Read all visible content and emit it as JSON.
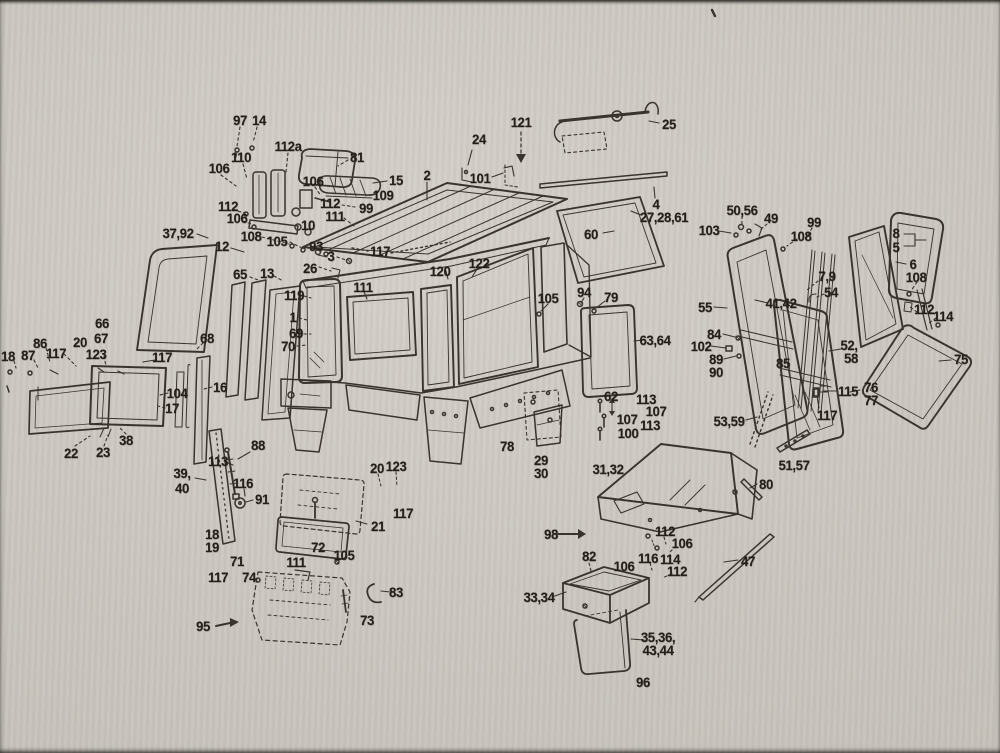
{
  "document": {
    "type": "scanned exploded-parts diagram",
    "subject": "tractor cab assembly parts figure with numbered callouts"
  },
  "colors": {
    "paper": "#cac6bf",
    "ink": "#2e2922"
  },
  "labels": [
    {
      "t": "97",
      "x": 240,
      "y": 120
    },
    {
      "t": "14",
      "x": 259,
      "y": 120
    },
    {
      "t": "112a",
      "x": 288,
      "y": 146
    },
    {
      "t": "110",
      "x": 241,
      "y": 157
    },
    {
      "t": "106",
      "x": 219,
      "y": 168
    },
    {
      "t": "81",
      "x": 357,
      "y": 157
    },
    {
      "t": "106",
      "x": 313,
      "y": 181
    },
    {
      "t": "15",
      "x": 396,
      "y": 180
    },
    {
      "t": "109",
      "x": 383,
      "y": 195
    },
    {
      "t": "112",
      "x": 330,
      "y": 203
    },
    {
      "t": "99",
      "x": 366,
      "y": 208
    },
    {
      "t": "111",
      "x": 335,
      "y": 216
    },
    {
      "t": "112",
      "x": 228,
      "y": 206
    },
    {
      "t": "106",
      "x": 237,
      "y": 218
    },
    {
      "t": "10",
      "x": 308,
      "y": 225
    },
    {
      "t": "108",
      "x": 251,
      "y": 236
    },
    {
      "t": "105",
      "x": 277,
      "y": 241
    },
    {
      "t": "12",
      "x": 222,
      "y": 246
    },
    {
      "t": "37,92",
      "x": 178,
      "y": 233
    },
    {
      "t": "93",
      "x": 316,
      "y": 246
    },
    {
      "t": "3",
      "x": 331,
      "y": 256
    },
    {
      "t": "26",
      "x": 310,
      "y": 268
    },
    {
      "t": "117",
      "x": 380,
      "y": 251
    },
    {
      "t": "65",
      "x": 240,
      "y": 274
    },
    {
      "t": "13",
      "x": 267,
      "y": 273
    },
    {
      "t": "119",
      "x": 294,
      "y": 295
    },
    {
      "t": "1",
      "x": 293,
      "y": 317
    },
    {
      "t": "69",
      "x": 296,
      "y": 333
    },
    {
      "t": "70",
      "x": 288,
      "y": 346
    },
    {
      "t": "66",
      "x": 102,
      "y": 323
    },
    {
      "t": "67",
      "x": 101,
      "y": 338
    },
    {
      "t": "20",
      "x": 80,
      "y": 342
    },
    {
      "t": "86",
      "x": 40,
      "y": 343
    },
    {
      "t": "18",
      "x": 8,
      "y": 356
    },
    {
      "t": "87",
      "x": 28,
      "y": 355
    },
    {
      "t": "117",
      "x": 56,
      "y": 353
    },
    {
      "t": "123",
      "x": 96,
      "y": 354
    },
    {
      "t": "117",
      "x": 162,
      "y": 357
    },
    {
      "t": "68",
      "x": 207,
      "y": 338
    },
    {
      "t": "104",
      "x": 177,
      "y": 393
    },
    {
      "t": "17",
      "x": 172,
      "y": 408
    },
    {
      "t": "16",
      "x": 220,
      "y": 387
    },
    {
      "t": "38",
      "x": 126,
      "y": 440
    },
    {
      "t": "22",
      "x": 71,
      "y": 453
    },
    {
      "t": "23",
      "x": 103,
      "y": 452
    },
    {
      "t": "121",
      "x": 521,
      "y": 122
    },
    {
      "t": "24",
      "x": 479,
      "y": 139
    },
    {
      "t": "101",
      "x": 480,
      "y": 178
    },
    {
      "t": "25",
      "x": 669,
      "y": 124
    },
    {
      "t": "2",
      "x": 427,
      "y": 175
    },
    {
      "t": "4",
      "x": 656,
      "y": 204
    },
    {
      "t": "27,28,61",
      "x": 664,
      "y": 217
    },
    {
      "t": "60",
      "x": 591,
      "y": 234
    },
    {
      "t": "120",
      "x": 440,
      "y": 271
    },
    {
      "t": "122",
      "x": 479,
      "y": 263
    },
    {
      "t": "111",
      "x": 363,
      "y": 287
    },
    {
      "t": "105",
      "x": 548,
      "y": 298
    },
    {
      "t": "94",
      "x": 584,
      "y": 292
    },
    {
      "t": "79",
      "x": 611,
      "y": 297
    },
    {
      "t": "63,64",
      "x": 655,
      "y": 340
    },
    {
      "t": "50,56",
      "x": 742,
      "y": 210
    },
    {
      "t": "49",
      "x": 771,
      "y": 218
    },
    {
      "t": "99",
      "x": 814,
      "y": 222
    },
    {
      "t": "103",
      "x": 709,
      "y": 230
    },
    {
      "t": "108",
      "x": 801,
      "y": 236
    },
    {
      "t": "7,9",
      "x": 827,
      "y": 276
    },
    {
      "t": "54",
      "x": 831,
      "y": 292
    },
    {
      "t": "8",
      "x": 896,
      "y": 233
    },
    {
      "t": "5",
      "x": 896,
      "y": 247
    },
    {
      "t": "6",
      "x": 913,
      "y": 264
    },
    {
      "t": "108",
      "x": 916,
      "y": 277
    },
    {
      "t": "112",
      "x": 924,
      "y": 309
    },
    {
      "t": "114",
      "x": 943,
      "y": 316
    },
    {
      "t": "55",
      "x": 705,
      "y": 307
    },
    {
      "t": "41,42",
      "x": 781,
      "y": 303
    },
    {
      "t": "84",
      "x": 714,
      "y": 334
    },
    {
      "t": "102",
      "x": 701,
      "y": 346
    },
    {
      "t": "89",
      "x": 716,
      "y": 359
    },
    {
      "t": "90",
      "x": 716,
      "y": 372
    },
    {
      "t": "85",
      "x": 783,
      "y": 363
    },
    {
      "t": "52,",
      "x": 849,
      "y": 345
    },
    {
      "t": "58",
      "x": 851,
      "y": 358
    },
    {
      "t": "115",
      "x": 848,
      "y": 391
    },
    {
      "t": "76",
      "x": 871,
      "y": 387
    },
    {
      "t": "77",
      "x": 871,
      "y": 400
    },
    {
      "t": "117",
      "x": 827,
      "y": 415
    },
    {
      "t": "53,59",
      "x": 729,
      "y": 421
    },
    {
      "t": "51,57",
      "x": 794,
      "y": 465
    },
    {
      "t": "75",
      "x": 961,
      "y": 359
    },
    {
      "t": "80",
      "x": 766,
      "y": 484
    },
    {
      "t": "47",
      "x": 748,
      "y": 561
    },
    {
      "t": "62",
      "x": 611,
      "y": 396
    },
    {
      "t": "113",
      "x": 646,
      "y": 399
    },
    {
      "t": "107",
      "x": 656,
      "y": 411
    },
    {
      "t": "107",
      "x": 627,
      "y": 419
    },
    {
      "t": "113",
      "x": 650,
      "y": 425
    },
    {
      "t": "100",
      "x": 628,
      "y": 433
    },
    {
      "t": "78",
      "x": 507,
      "y": 446
    },
    {
      "t": "29",
      "x": 541,
      "y": 460
    },
    {
      "t": "30",
      "x": 541,
      "y": 473
    },
    {
      "t": "31,32",
      "x": 608,
      "y": 469
    },
    {
      "t": "98",
      "x": 551,
      "y": 534
    },
    {
      "t": "82",
      "x": 589,
      "y": 556
    },
    {
      "t": "112",
      "x": 665,
      "y": 531
    },
    {
      "t": "106",
      "x": 682,
      "y": 543
    },
    {
      "t": "116",
      "x": 648,
      "y": 558
    },
    {
      "t": "114",
      "x": 670,
      "y": 559
    },
    {
      "t": "112",
      "x": 677,
      "y": 571
    },
    {
      "t": "106",
      "x": 624,
      "y": 566
    },
    {
      "t": "33,34",
      "x": 539,
      "y": 597
    },
    {
      "t": "35,36,",
      "x": 658,
      "y": 637
    },
    {
      "t": "43,44",
      "x": 658,
      "y": 650
    },
    {
      "t": "96",
      "x": 643,
      "y": 682
    },
    {
      "t": "88",
      "x": 258,
      "y": 445
    },
    {
      "t": "113",
      "x": 218,
      "y": 461
    },
    {
      "t": "39,",
      "x": 182,
      "y": 473
    },
    {
      "t": "40",
      "x": 182,
      "y": 488
    },
    {
      "t": "116",
      "x": 243,
      "y": 483
    },
    {
      "t": "91",
      "x": 262,
      "y": 499
    },
    {
      "t": "20",
      "x": 377,
      "y": 468
    },
    {
      "t": "123",
      "x": 396,
      "y": 466
    },
    {
      "t": "117",
      "x": 403,
      "y": 513
    },
    {
      "t": "21",
      "x": 378,
      "y": 526
    },
    {
      "t": "18",
      "x": 212,
      "y": 534
    },
    {
      "t": "19",
      "x": 212,
      "y": 547
    },
    {
      "t": "71",
      "x": 237,
      "y": 561
    },
    {
      "t": "72",
      "x": 318,
      "y": 547
    },
    {
      "t": "105",
      "x": 344,
      "y": 555
    },
    {
      "t": "111",
      "x": 296,
      "y": 562
    },
    {
      "t": "117",
      "x": 218,
      "y": 577
    },
    {
      "t": "74",
      "x": 249,
      "y": 577
    },
    {
      "t": "83",
      "x": 396,
      "y": 592
    },
    {
      "t": "73",
      "x": 367,
      "y": 620
    },
    {
      "t": "95",
      "x": 203,
      "y": 626
    }
  ]
}
